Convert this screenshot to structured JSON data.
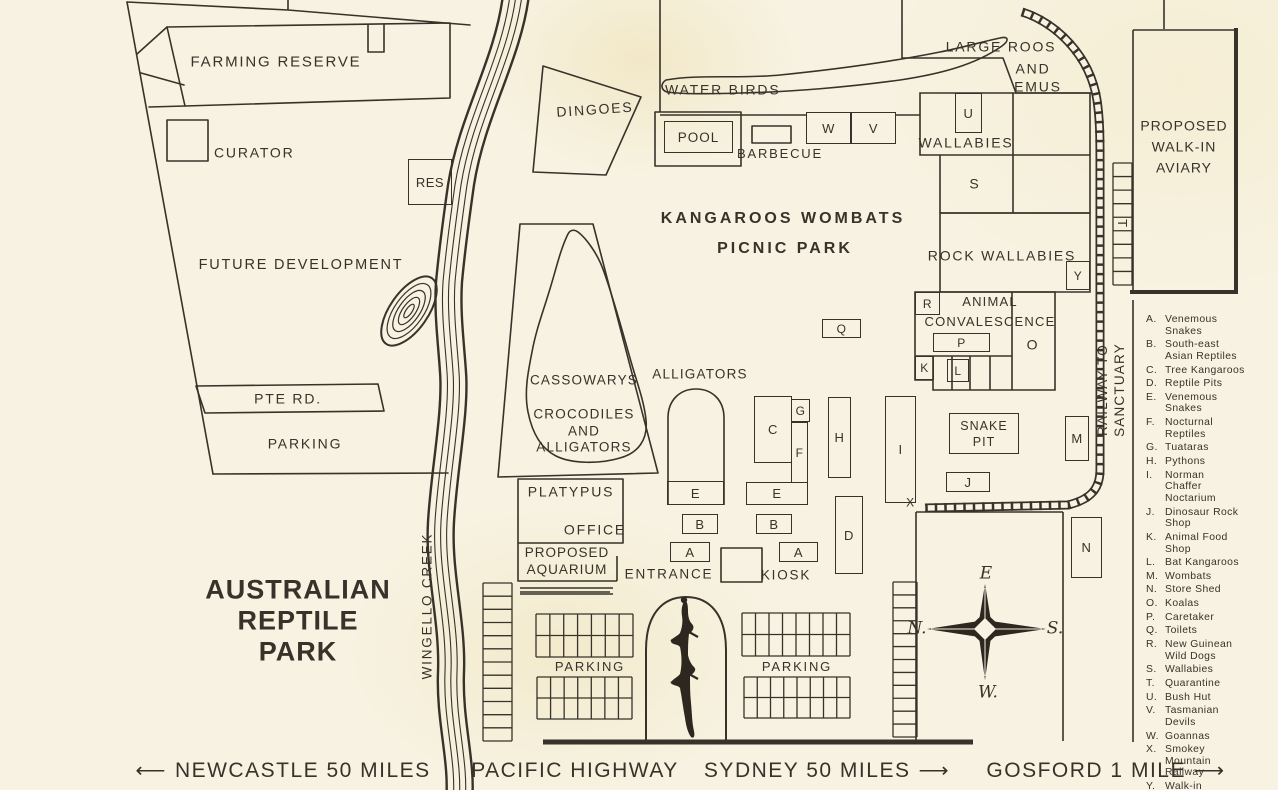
{
  "title": "AUSTRALIAN\nREPTILE\nPARK",
  "roads": {
    "left_arrow": "⟵",
    "right_arrow": "⟶",
    "newcastle": "NEWCASTLE 50 MILES",
    "pacific_highway": "PACIFIC HIGHWAY",
    "sydney": "SYDNEY 50 MILES",
    "gosford": "GOSFORD 1 MILE"
  },
  "waterways": {
    "creek": "WINGELLO CREEK"
  },
  "railway": {
    "label": "RAILWAY TO SANCTUARY",
    "terminus": "X"
  },
  "areas": {
    "farming_reserve": "FARMING RESERVE",
    "curator": "CURATOR",
    "future_development": "FUTURE DEVELOPMENT",
    "pte_rd": "PTE RD.",
    "parking_west": "PARKING",
    "dingoes": "DINGOES",
    "water_birds": "WATER BIRDS",
    "pool": "POOL",
    "barbecue": "BARBECUE",
    "kangaroos_wombats": "KANGAROOS WOMBATS",
    "picnic_park": "PICNIC PARK",
    "large_roos_l1": "LARGE ROOS",
    "large_roos_l2": "AND",
    "large_roos_l3": "EMUS",
    "wallabies": "WALLABIES",
    "rock_wallabies": "ROCK WALLABIES",
    "animal_convalescence": "ANIMAL\nCONVALESCENCE",
    "snake_pit": "SNAKE\nPIT",
    "cassowarys": "CASSOWARYS",
    "crocodiles": "CROCODILES\nAND\nALLIGATORS",
    "alligators": "ALLIGATORS",
    "platypus": "PLATYPUS",
    "office": "OFFICE",
    "proposed_aquarium": "PROPOSED\nAQUARIUM",
    "entrance": "ENTRANCE",
    "kiosk": "KIOSK",
    "parking_south_1": "PARKING",
    "parking_south_2": "PARKING",
    "proposed_aviary": "PROPOSED\nWALK-IN\nAVIARY"
  },
  "boxes": {
    "res": "RES",
    "w": "W",
    "v": "V",
    "u": "U",
    "y": "Y",
    "r": "R",
    "p": "P",
    "k": "K",
    "l": "L",
    "m": "M",
    "n": "N",
    "q": "Q",
    "c": "C",
    "g": "G",
    "f": "F",
    "h": "H",
    "i": "I",
    "d": "D",
    "e1": "E",
    "e2": "E",
    "b1": "B",
    "b2": "B",
    "a1": "A",
    "a2": "A",
    "j": "J",
    "s": "S",
    "o": "O",
    "t": "T",
    "x": "X"
  },
  "compass": {
    "e": "E",
    "n": "N.",
    "s": "S.",
    "w": "W."
  },
  "legend": {
    "items": [
      {
        "key": "A.",
        "label": "Venemous\nSnakes"
      },
      {
        "key": "B.",
        "label": "South-east\nAsian Reptiles"
      },
      {
        "key": "C.",
        "label": "Tree Kangaroos"
      },
      {
        "key": "D.",
        "label": "Reptile Pits"
      },
      {
        "key": "E.",
        "label": "Venemous\nSnakes"
      },
      {
        "key": "F.",
        "label": "Nocturnal\nReptiles"
      },
      {
        "key": "G.",
        "label": "Tuataras"
      },
      {
        "key": "H.",
        "label": "Pythons"
      },
      {
        "key": "I.",
        "label": "Norman\nChaffer\nNoctarium"
      },
      {
        "key": "J.",
        "label": "Dinosaur Rock\nShop"
      },
      {
        "key": "K.",
        "label": "Animal Food\nShop"
      },
      {
        "key": "L.",
        "label": "Bat Kangaroos"
      },
      {
        "key": "M.",
        "label": "Wombats"
      },
      {
        "key": "N.",
        "label": "Store Shed"
      },
      {
        "key": "O.",
        "label": "Koalas"
      },
      {
        "key": "P.",
        "label": "Caretaker"
      },
      {
        "key": "Q.",
        "label": "Toilets"
      },
      {
        "key": "R.",
        "label": "New Guinean\nWild Dogs"
      },
      {
        "key": "S.",
        "label": "Wallabies"
      },
      {
        "key": "T.",
        "label": "Quarantine"
      },
      {
        "key": "U.",
        "label": "Bush Hut"
      },
      {
        "key": "V.",
        "label": "Tasmanian\nDevils"
      },
      {
        "key": "W.",
        "label": "Goannas"
      },
      {
        "key": "X.",
        "label": "Smokey\nMountain\nRailway"
      },
      {
        "key": "Y.",
        "label": "Walk-in\nAviary"
      }
    ]
  }
}
